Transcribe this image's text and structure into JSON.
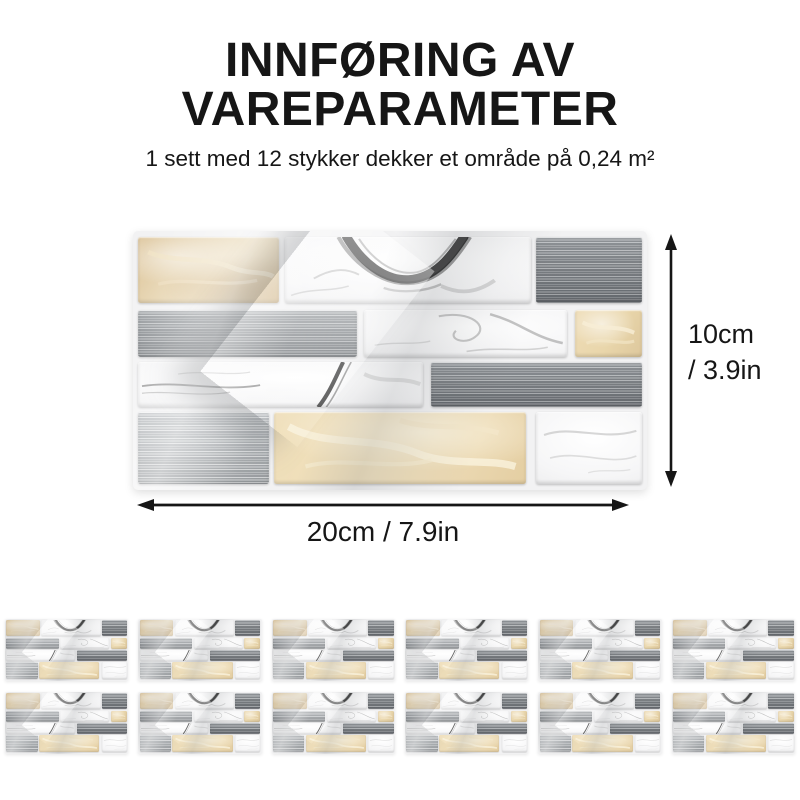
{
  "header": {
    "title_lines": [
      "INNFØRING AV",
      "VAREPARAMETER"
    ],
    "subtitle": "1 sett med 12 stykker dekker et område på 0,24 m²"
  },
  "dimensions": {
    "height_label_line1": "10cm",
    "height_label_line2": "/ 3.9in",
    "width_label": "20cm / 7.9in"
  },
  "thumbnails": {
    "count": 12,
    "columns": 6
  },
  "panel": {
    "rows": [
      {
        "top": 2.2,
        "height": 25.5,
        "bricks": [
          {
            "type": "beige_dark",
            "left": 1,
            "width": 27.5
          },
          {
            "type": "marble_swirl",
            "left": 29.5,
            "width": 48
          },
          {
            "type": "steel_dark",
            "left": 78.5,
            "width": 20.5
          }
        ]
      },
      {
        "top": 30.5,
        "height": 18,
        "bricks": [
          {
            "type": "steel",
            "left": 1,
            "width": 42.5
          },
          {
            "type": "marble_vein",
            "left": 45,
            "width": 39.5
          },
          {
            "type": "beige",
            "left": 86,
            "width": 13
          }
        ]
      },
      {
        "top": 50.5,
        "height": 17.5,
        "bricks": [
          {
            "type": "marble_streak",
            "left": 1,
            "width": 55.5
          },
          {
            "type": "steel_dark",
            "left": 58,
            "width": 41
          }
        ]
      },
      {
        "top": 70,
        "height": 27.5,
        "bricks": [
          {
            "type": "steel_light",
            "left": 1,
            "width": 25.5
          },
          {
            "type": "beige_light",
            "left": 27.5,
            "width": 49
          },
          {
            "type": "marble_soft",
            "left": 78.5,
            "width": 20.5
          }
        ]
      }
    ]
  },
  "colors": {
    "text": "#161616",
    "page-bg": "#ffffff",
    "panel-grout": "#f2f2f3",
    "steel-mid": "#8f9397",
    "steel-light": "#b6babd",
    "beige-dark": "#dcc49a",
    "beige-mid": "#e9d6ab",
    "beige-light": "#eedcb4",
    "marble-base": "#f6f6f7"
  }
}
